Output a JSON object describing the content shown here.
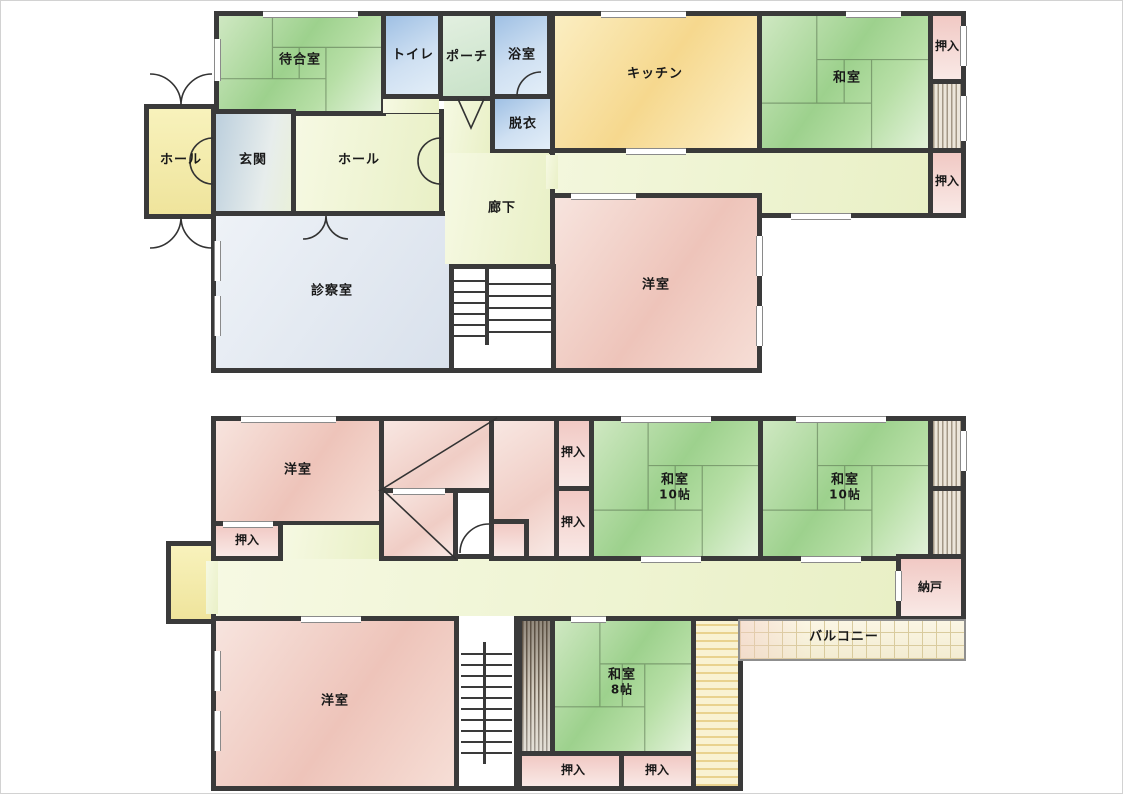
{
  "f1": {
    "waiting_room": "待合室",
    "toilet": "トイレ",
    "porch": "ポーチ",
    "bathroom": "浴室",
    "dressing": "脱衣",
    "kitchen": "キッチン",
    "washitsu": "和室",
    "closet_ne": "押入",
    "closet_e": "押入",
    "hall_west": "ホール",
    "entrance": "玄関",
    "hall_center": "ホール",
    "corridor": "廊下",
    "exam_room": "診察室",
    "western_room": "洋室"
  },
  "f2": {
    "western_room_nw": "洋室",
    "closet_nw": "押入",
    "closet_c1": "押入",
    "closet_c2": "押入",
    "washitsu_center": "和室",
    "washitsu_center_size": "10帖",
    "washitsu_east": "和室",
    "washitsu_east_size": "10帖",
    "storeroom": "納戸",
    "balcony": "バルコニー",
    "western_room_sw": "洋室",
    "washitsu_south": "和室",
    "washitsu_south_size": "8帖",
    "closet_s1": "押入",
    "closet_s2": "押入"
  },
  "palette": {
    "wall": "#3a3a3a",
    "tatami_green": "#9dd18d",
    "room_pink": "#eec4ba",
    "kitchen_yellow": "#f6d88e",
    "corridor_green": "#edf2c9",
    "water_blue": "#a9c8e8",
    "hall_yellow": "#f5eeb0",
    "exam_gray": "#dfe6ee",
    "balcony_cream": "#f7f0d8"
  }
}
